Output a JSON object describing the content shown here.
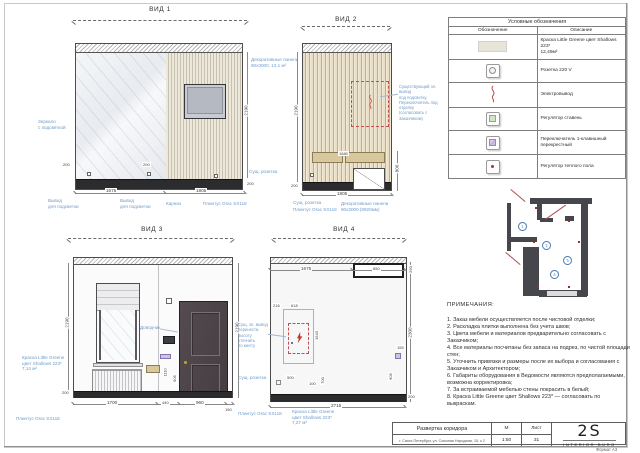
{
  "sheet": {
    "format": "Формат А3"
  },
  "colors": {
    "annotation_blue": "#6f9ac8",
    "marker_red": "#b05050",
    "paint_swatch": "#e7e5da",
    "wood": "#d9c79e"
  },
  "views": {
    "v1": {
      "title": "ВИД 1",
      "dims": {
        "h": "2190",
        "base": "200",
        "w1": "1675",
        "w2": "1805",
        "s1": "200",
        "s2": "200"
      },
      "labels": {
        "mirror": "Зеркало\nс подсветкой",
        "panels": "Декоративные панели\n90х3000, 12,1 м²",
        "socket": "Сущ. розетка",
        "out": "Вывод\nдля подсветки",
        "cornice": "Карниз",
        "plinth": "Плинтус Orac SX118"
      }
    },
    "v2": {
      "title": "ВИД 2",
      "dims": {
        "h": "2190",
        "base": "200",
        "w": "1805",
        "cab": "800",
        "shelf": "1680"
      },
      "labels": {
        "note": "Существующий эл. вывод\nпод подсветку.\nПереключатель под отделку\n(согласовать с Заказчиком)",
        "socket": "Сущ. розетка",
        "plinth": "Плинтус Orac SX118",
        "panels": "Декоративные панели\n90х3000 (8920мм)"
      }
    },
    "v3": {
      "title": "ВИД 3",
      "dims": {
        "hl": "2190",
        "hr": "2190",
        "base": "200",
        "w1": "1700",
        "w2": "440",
        "w3": "960",
        "w4": "150",
        "t1": "1110",
        "t2": "905"
      },
      "labels": {
        "paint": "Краска Little Greene\nцвет Shallows 223*\n7,14 м²",
        "closer": "Доводчик",
        "socket": "Сущ. розетка",
        "plinth": "Плинтус Orac SX118"
      }
    },
    "v4": {
      "title": "ВИД 4",
      "dims": {
        "t1": "1675",
        "t2": "650",
        "r1": "290",
        "r2": "2300",
        "r3": "200",
        "w": "2715",
        "b1": "216",
        "b2": "618",
        "b3": "1543",
        "b4": "500",
        "b5": "100",
        "b6": "700",
        "b7": "155",
        "b8": "905"
      },
      "labels": {
        "note": "Сущ. эл. вывод\nперенести,\nвысоту уточнить\nпо месту",
        "paint": "Краска Little Greene\nцвет Shallows 223*\n7,27 м²",
        "plinth": "Плинтус Orac SX118"
      }
    }
  },
  "legend": {
    "title": "Условные обозначения",
    "col_symbol": "Обозначение",
    "col_desc": "Описание",
    "rows": [
      {
        "icon": "paint-swatch",
        "desc": "Краска Little Greene цвет Shallows 223*\n12,49м²"
      },
      {
        "icon": "socket",
        "desc": "Розетка 220 V"
      },
      {
        "icon": "electric-output",
        "desc": "Электровывод"
      },
      {
        "icon": "dimmer",
        "desc": "Регулятор ставень"
      },
      {
        "icon": "cross-switch",
        "desc": "Переключатель 1-клавишный перекрестный"
      },
      {
        "icon": "floor-heating",
        "desc": "Регулятор теплого пола"
      }
    ]
  },
  "plan": {
    "markers": [
      "1",
      "2",
      "3",
      "4"
    ]
  },
  "notes": {
    "title": "ПРИМЕЧАНИЯ:",
    "items": [
      "1. Заказ мебели осуществляется после чистовой отделки;",
      "2. Раскладка плитки выполнена без учета швов;",
      "3. Цвета мебели и материалов предварительно согласовать с Заказчиком;",
      "4. Все материалы посчитаны без запаса на подрез, по чистой площади стен;",
      "5. Уточнить привязки и размеры после их выбора и согласования с Заказчиком и Архитектором;",
      "6. Габариты оборудования в Ведомости являются предполагаемыми, возможна корректировка;",
      "7. За встраиваемой мебелью стены покрасить в белый;",
      "8. Краска Little Greene цвет Shallows 223* — согласовать по выкраскам."
    ]
  },
  "titleblock": {
    "drawing_title": "Развертка коридора",
    "address": "г. Санкт-Петербург, ул. Союзная Народная, 15, к 2",
    "scale_label": "М",
    "scale_value": "1:50",
    "sheet_label": "Лист",
    "sheet_value": "31",
    "logo": "2S",
    "logo_sub": "INTERIOR BURO"
  }
}
